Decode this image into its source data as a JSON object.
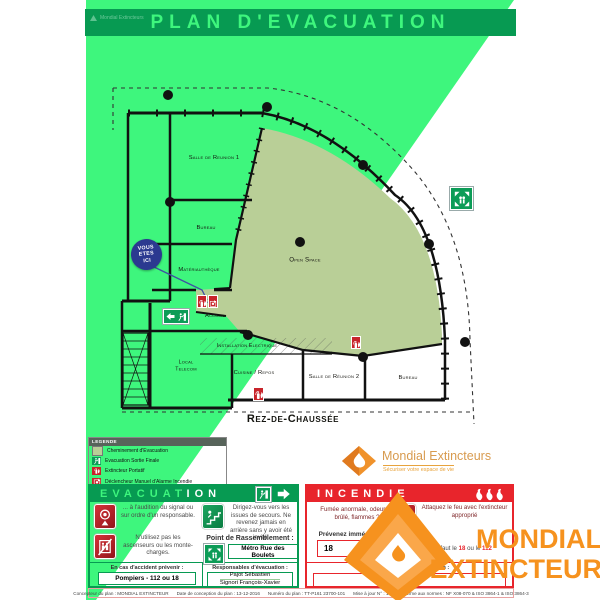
{
  "title": "PLAN D'EVACUATION",
  "header_brand": "Mondial Extincteurs",
  "floor_label": "Rez-de-Chaussée",
  "colors": {
    "overlay_green": "#3EF67D",
    "dark_green": "#079A52",
    "incendie_red": "#E8252C",
    "evacuation_zone_olive": "#B9CF97",
    "watermark_orange": "#F6921E",
    "you_are_here_blue": "#2B3990"
  },
  "plan": {
    "you_are_here": {
      "line1": "VOUS",
      "line2": "ETES",
      "line3": "ICI"
    },
    "rooms": {
      "salle_reunion_1": "Salle de Reunion 1",
      "bureau_gauche": "Bureau",
      "materiautheque": "Matériauthèque",
      "accueil": "Accueil",
      "open_space": "Open Space",
      "installation_electrique": "Installation Electrique",
      "local_telecom_l1": "Local",
      "local_telecom_l2": "Telecom",
      "cuisine_repos": "Cuisine / Repos",
      "salle_reunion_2": "Salle de Réunion 2",
      "bureau_droite": "Bureau"
    }
  },
  "legend": {
    "title": "LEGENDE",
    "items": [
      {
        "label": "Cheminement d'Evacuation",
        "icon": "evacuation-path"
      },
      {
        "label": "Evacuation Sortie Finale",
        "icon": "final-exit"
      },
      {
        "label": "Extincteur Portatif",
        "icon": "extinguisher"
      },
      {
        "label": "Déclencheur Manuel d'Alarme Incendie",
        "icon": "manual-alarm"
      },
      {
        "label": "Point de Rassemblement",
        "icon": "assembly-point"
      }
    ]
  },
  "brand": {
    "name": "Mondial Extincteurs",
    "tagline": "Sécuriser votre espace de vie"
  },
  "evacuation": {
    "title": "EVACUATION",
    "instruction_signal": "... à l'audition du signal ou sur ordre d'un responsable.",
    "instruction_elevator": "N'utilisez pas les ascenseurs ou les monte-charges.",
    "instruction_exits": "Dirigez-vous vers les issues de secours. Ne revenez jamais en arrière sans y avoir été invité.",
    "rally_label": "Point de Rassemblement :",
    "rally_value": "Métro Rue des Boulets",
    "accident_label": "En cas d'accident prévenir :",
    "accident_value": "Pompiers - 112 ou 18",
    "responsible_label": "Responsables d'évacuation :",
    "responsible_name_1": "Pajot Sébastien",
    "responsible_name_2": "Signori François-Xavier"
  },
  "incendie": {
    "title": "INCENDIE",
    "alert_text": "Fumée anormale, odeur de brûlé, flammes ?",
    "notify_label": "Prévenez immédiatement",
    "notify_number": "18",
    "attack_text": "Attaquez le feu avec l'extincteur approprié",
    "fallback_prefix": "ou à défaut le",
    "fallback_num1": "18",
    "fallback_mid": "ou le",
    "fallback_num2": "112",
    "responsible_label": "Responsables d'intervention :"
  },
  "watermark": {
    "line1": "MONDIAL",
    "line2": "EXTINCTEUR"
  },
  "footer": {
    "designer": "Concepteur du plan : MONDIAL EXTINCTEUR",
    "date": "Date de conception du plan : 13-12-2016",
    "number": "Numéro du plan : TT-P161 23700-101",
    "update": "Mise à jour N° : 1",
    "norms": "Conforme aux normes : NF X08-070 & ISO 3864-1 & ISO 3864-3"
  }
}
